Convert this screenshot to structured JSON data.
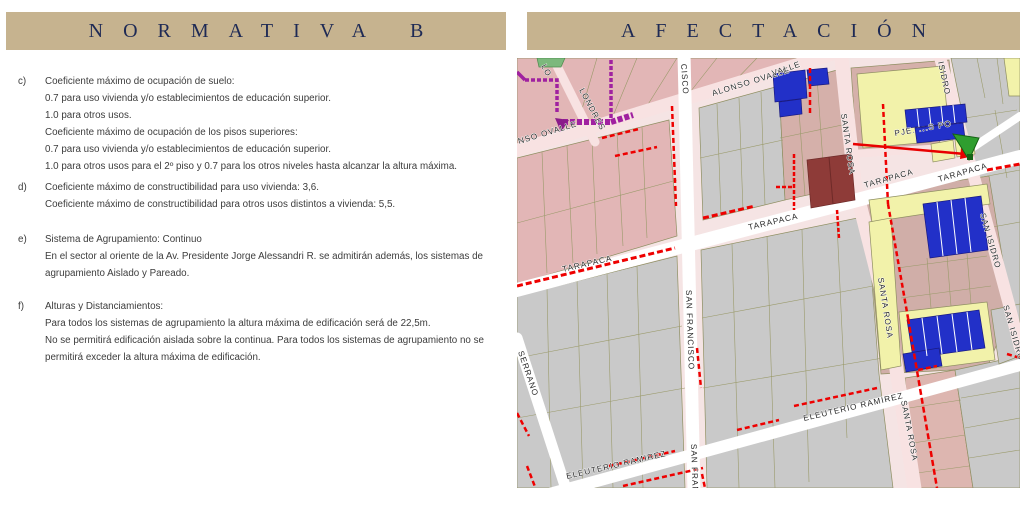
{
  "headers": {
    "left": "NORMATIVA B",
    "right": "AFECTACIÓN",
    "bar_color": "#c6b38f",
    "text_color": "#1e2a55"
  },
  "normativa": {
    "items": [
      {
        "id": "c)",
        "lines": [
          "Coeficiente máximo de ocupación de suelo:",
          "0.7 para uso vivienda y/o establecimientos de educación superior.",
          "1.0 para otros usos.",
          "Coeficiente máximo de ocupación de los pisos superiores:",
          "0.7 para uso vivienda y/o establecimientos de educación superior.",
          "1.0 para otros usos para el 2º piso y 0.7 para los otros niveles hasta alcanzar la altura máxima."
        ]
      },
      {
        "id": "d)",
        "lines": [
          "Coeficiente máximo de constructibilidad para uso vivienda: 3,6.",
          "Coeficiente máximo de constructibilidad para otros usos distintos a vivienda: 5,5."
        ]
      },
      {
        "id": "e)",
        "lines": [
          "Sistema de Agrupamiento: Continuo",
          "En el sector al oriente de la Av. Presidente Jorge Alessandri R. se admitirán además, los sistemas de",
          "agrupamiento Aislado y Pareado."
        ]
      },
      {
        "id": "f)",
        "lines": [
          "Alturas y Distanciamientos:",
          "Para todos los sistemas de agrupamiento la altura máxima de edificación será de 22,5m.",
          "No se permitirá edificación aislada sobre la continua. Para todos los sistemas de agrupamiento no se",
          "permitirá exceder la altura máxima de edificación."
        ]
      }
    ]
  },
  "map": {
    "labels": [
      {
        "text": "LO"
      },
      {
        "text": "LONDRES"
      },
      {
        "text": "NSO OVALLE"
      },
      {
        "text": "ALONSO OVALLE"
      },
      {
        "text": "VALLE"
      },
      {
        "text": "CISCO"
      },
      {
        "text": "SAN FRANCISCO"
      },
      {
        "text": "SAN FRAN"
      },
      {
        "text": "TARAPACA"
      },
      {
        "text": "TARAPACA"
      },
      {
        "text": "TARAPACA"
      },
      {
        "text": "TARAPACA"
      },
      {
        "text": "SANTA ROSA"
      },
      {
        "text": "SANTA ROSA"
      },
      {
        "text": "SANTA ROSA"
      },
      {
        "text": "ISIDRO"
      },
      {
        "text": "SAN ISIDRO"
      },
      {
        "text": "SAN ISIDRO"
      },
      {
        "text": "ELEUTERIO RAMIREZ"
      },
      {
        "text": "ELEUTERIO RAMIREZ"
      },
      {
        "text": "SERRANO"
      },
      {
        "text": "PJE. ...S PO"
      }
    ],
    "colors": {
      "block_pink": "#e2b6b6",
      "block_dusty": "#d5b0aa",
      "block_gray": "#c9c9c9",
      "street_pink": "#f8e2e2",
      "street_white": "#ffffff",
      "building_blue": "#2230c8",
      "building_yellow": "#f2f2aa",
      "building_maroon": "#8e3b38",
      "affectation_red": "#ee0000",
      "line_purple": "#a021a0",
      "marker_green": "#2f9e2f",
      "outline_olive": "#8f8f62"
    }
  }
}
